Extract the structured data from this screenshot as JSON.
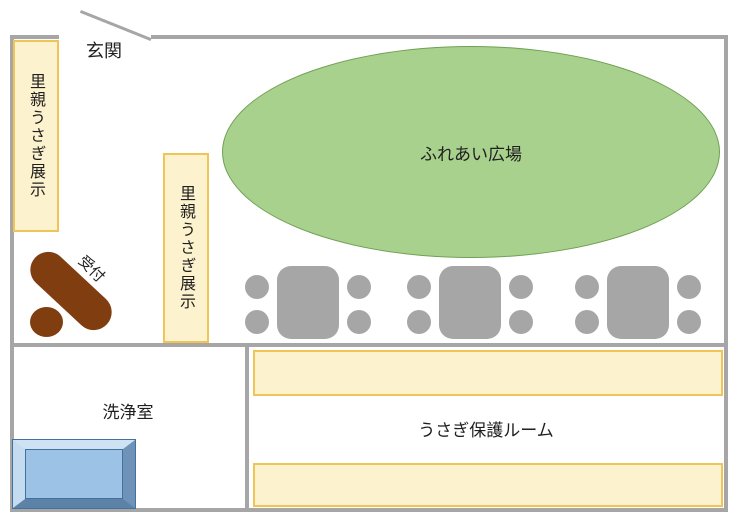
{
  "title": "rabbit-shelter-floor-plan",
  "labels": {
    "entrance": "玄関",
    "foster_display_left": "里親うさぎ展示",
    "foster_display_center": "里親うさぎ展示",
    "petting_plaza": "ふれあい広場",
    "reception": "受付",
    "washing_room": "洗浄室",
    "rabbit_care_room": "うさぎ保護ルーム"
  },
  "furniture": {
    "table_set_count": 3,
    "chairs_per_table": 4,
    "cage_shelf_count": 2
  },
  "palette": {
    "wall_gray": "#a6a6a6",
    "furniture_gray": "#a6a6a6",
    "display_fill": "#fdf2ce",
    "display_border": "#f0c457",
    "plaza_fill": "#a9d18e",
    "plaza_border": "#6fa052",
    "reception_brown": "#7f3d10",
    "sink_blue": "#9cc3e5",
    "sink_outline": "#41719c",
    "text": "#1f1f1f"
  }
}
